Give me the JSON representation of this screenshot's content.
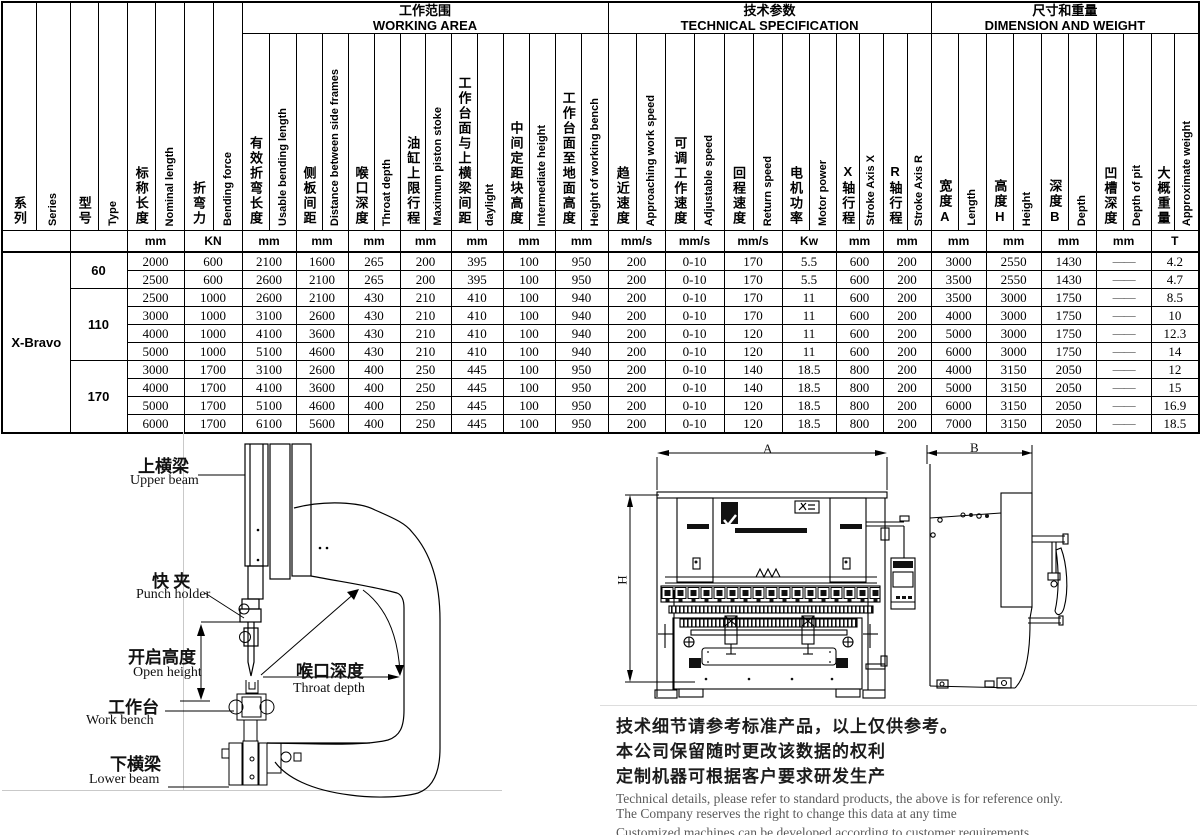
{
  "table": {
    "groups": [
      {
        "cn": "工作范围",
        "en": "WORKING AREA"
      },
      {
        "cn": "技术参数",
        "en": "TECHNICAL SPECIFICATION"
      },
      {
        "cn": "尺寸和重量",
        "en": "DIMENSION AND WEIGHT"
      }
    ],
    "columns": [
      {
        "cn": "系列",
        "en": "Series",
        "unit": ""
      },
      {
        "cn": "型号",
        "en": "Type",
        "unit": ""
      },
      {
        "cn": "标称长度",
        "en": "Nominal length",
        "unit": "mm"
      },
      {
        "cn": "折弯力",
        "en": "Bending force",
        "unit": "KN"
      },
      {
        "cn": "有效折弯长度",
        "en": "Usable bending length",
        "unit": "mm"
      },
      {
        "cn": "侧板间距",
        "en": "Distance between side frames",
        "unit": "mm"
      },
      {
        "cn": "喉口深度",
        "en": "Throat depth",
        "unit": "mm"
      },
      {
        "cn": "油缸上限行程",
        "en": "Maximum piston stoke",
        "unit": "mm"
      },
      {
        "cn": "工作台面与上横梁间距",
        "en": "daylight",
        "unit": "mm"
      },
      {
        "cn": "中间定距块高度",
        "en": "Intermediate height",
        "unit": "mm"
      },
      {
        "cn": "工作台面至地面高度",
        "en": "Height of working bench",
        "unit": "mm"
      },
      {
        "cn": "趋近速度",
        "en": "Approaching work speed",
        "unit": "mm/s"
      },
      {
        "cn": "可调工作速度",
        "en": "Adjustable speed",
        "unit": "mm/s"
      },
      {
        "cn": "回程速度",
        "en": "Return speed",
        "unit": "mm/s"
      },
      {
        "cn": "电机功率",
        "en": "Motor power",
        "unit": "Kw"
      },
      {
        "cn": "X轴行程",
        "en": "Stroke Axis X",
        "unit": "mm"
      },
      {
        "cn": "R轴行程",
        "en": "Stroke Axis R",
        "unit": "mm"
      },
      {
        "cn": "宽度A",
        "en": "Length",
        "unit": "mm"
      },
      {
        "cn": "高度H",
        "en": "Height",
        "unit": "mm"
      },
      {
        "cn": "深度B",
        "en": "Depth",
        "unit": "mm"
      },
      {
        "cn": "凹槽深度",
        "en": "Depth of pit",
        "unit": "mm"
      },
      {
        "cn": "大概重量",
        "en": "Approximate weight",
        "unit": "T"
      }
    ],
    "series": "X-Bravo",
    "type_groups": [
      {
        "label": "60",
        "rows": 2
      },
      {
        "label": "110",
        "rows": 4
      },
      {
        "label": "170",
        "rows": 4
      }
    ],
    "rows": [
      [
        "2000",
        "600",
        "2100",
        "1600",
        "265",
        "200",
        "395",
        "100",
        "950",
        "200",
        "0-10",
        "170",
        "5.5",
        "600",
        "200",
        "3000",
        "2550",
        "1430",
        "——",
        "4.2"
      ],
      [
        "2500",
        "600",
        "2600",
        "2100",
        "265",
        "200",
        "395",
        "100",
        "950",
        "200",
        "0-10",
        "170",
        "5.5",
        "600",
        "200",
        "3500",
        "2550",
        "1430",
        "——",
        "4.7"
      ],
      [
        "2500",
        "1000",
        "2600",
        "2100",
        "430",
        "210",
        "410",
        "100",
        "940",
        "200",
        "0-10",
        "170",
        "11",
        "600",
        "200",
        "3500",
        "3000",
        "1750",
        "——",
        "8.5"
      ],
      [
        "3000",
        "1000",
        "3100",
        "2600",
        "430",
        "210",
        "410",
        "100",
        "940",
        "200",
        "0-10",
        "170",
        "11",
        "600",
        "200",
        "4000",
        "3000",
        "1750",
        "——",
        "10"
      ],
      [
        "4000",
        "1000",
        "4100",
        "3600",
        "430",
        "210",
        "410",
        "100",
        "940",
        "200",
        "0-10",
        "120",
        "11",
        "600",
        "200",
        "5000",
        "3000",
        "1750",
        "——",
        "12.3"
      ],
      [
        "5000",
        "1000",
        "5100",
        "4600",
        "430",
        "210",
        "410",
        "100",
        "940",
        "200",
        "0-10",
        "120",
        "11",
        "600",
        "200",
        "6000",
        "3000",
        "1750",
        "——",
        "14"
      ],
      [
        "3000",
        "1700",
        "3100",
        "2600",
        "400",
        "250",
        "445",
        "100",
        "950",
        "200",
        "0-10",
        "140",
        "18.5",
        "800",
        "200",
        "4000",
        "3150",
        "2050",
        "——",
        "12"
      ],
      [
        "4000",
        "1700",
        "4100",
        "3600",
        "400",
        "250",
        "445",
        "100",
        "950",
        "200",
        "0-10",
        "140",
        "18.5",
        "800",
        "200",
        "5000",
        "3150",
        "2050",
        "——",
        "15"
      ],
      [
        "5000",
        "1700",
        "5100",
        "4600",
        "400",
        "250",
        "445",
        "100",
        "950",
        "200",
        "0-10",
        "120",
        "18.5",
        "800",
        "200",
        "6000",
        "3150",
        "2050",
        "——",
        "16.9"
      ],
      [
        "6000",
        "1700",
        "6100",
        "5600",
        "400",
        "250",
        "445",
        "100",
        "950",
        "200",
        "0-10",
        "120",
        "18.5",
        "800",
        "200",
        "7000",
        "3150",
        "2050",
        "——",
        "18.5"
      ]
    ]
  },
  "section_diagram": {
    "labels": {
      "upper_beam": {
        "cn": "上横梁",
        "en": "Upper beam"
      },
      "punch_holder": {
        "cn": "快 夹",
        "en": "Punch holder"
      },
      "open_height": {
        "cn": "开启高度",
        "en": "Open height"
      },
      "throat_depth": {
        "cn": "喉口深度",
        "en": "Throat depth"
      },
      "work_bench": {
        "cn": "工作台",
        "en": "Work bench"
      },
      "lower_beam": {
        "cn": "下横梁",
        "en": "Lower beam"
      }
    }
  },
  "views": {
    "dim_a": "A",
    "dim_h": "H",
    "dim_b": "B"
  },
  "disclaimer": {
    "cn": [
      "技术细节请参考标准产品，以上仅供参考。",
      "本公司保留随时更改该数据的权利",
      "定制机器可根据客户要求研发生产"
    ],
    "en": [
      "Technical details, please refer to standard products, the above is for reference only.",
      "The Company reserves the right to change this data at any time",
      "Customized machines can be developed according to customer requirements"
    ]
  }
}
